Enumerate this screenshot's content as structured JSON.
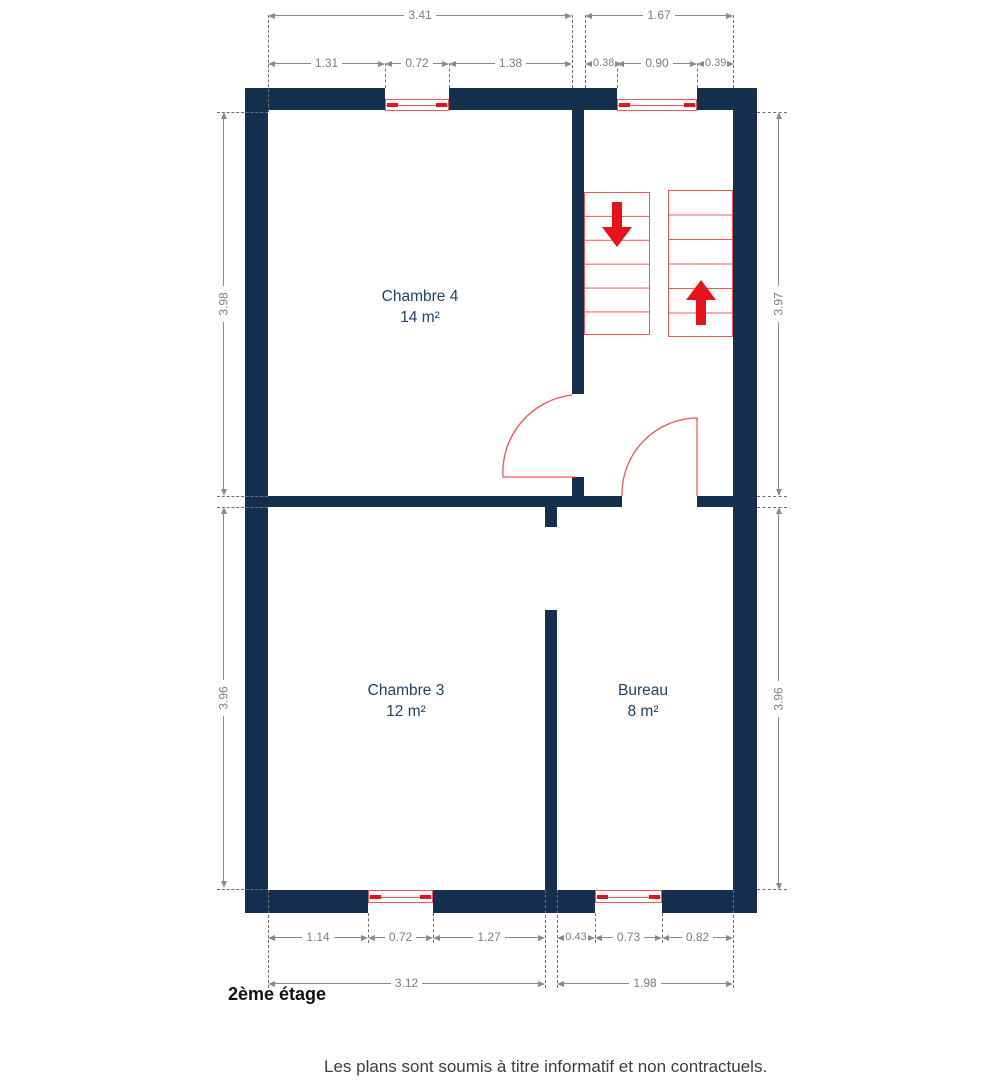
{
  "floor_label": "2ème étage",
  "disclaimer": "Les plans sont soumis à titre informatif et non contractuels.",
  "rooms": [
    {
      "name": "Chambre 4",
      "area": "14 m²"
    },
    {
      "name": "Chambre 3",
      "area": "12 m²"
    },
    {
      "name": "Bureau",
      "area": "8 m²"
    }
  ],
  "dims": {
    "top_totals": [
      "3.41",
      "1.67"
    ],
    "top_segments": [
      "1.31",
      "0.72",
      "1.38",
      "0.38",
      "0.90",
      "0.39"
    ],
    "bottom_segments": [
      "1.14",
      "0.72",
      "1.27",
      "0.43",
      "0.73",
      "0.82"
    ],
    "bottom_totals": [
      "3.12",
      "1.98"
    ],
    "left": [
      "3.98",
      "3.96"
    ],
    "right": [
      "3.97",
      "3.96"
    ]
  },
  "stairs": {
    "down_icon": "arrow-down",
    "up_icon": "arrow-up"
  },
  "colors": {
    "wall": "#14304e",
    "accent_red": "#e8121a",
    "line_red": "#f0555a",
    "room_text": "#1e4268",
    "dim_text": "#7d7d7d",
    "dim_line": "#8a8a8a",
    "ext_line": "#6f6f6f",
    "floor_text": "#111111",
    "footer_text": "#3d3d3d"
  }
}
